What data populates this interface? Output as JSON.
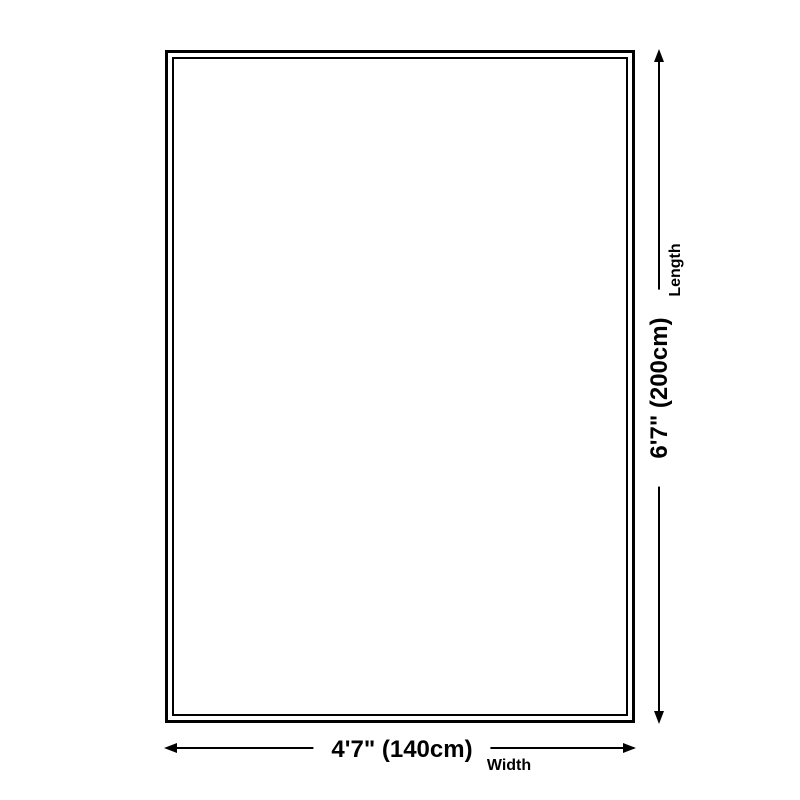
{
  "colors": {
    "line": "#000000",
    "background": "#ffffff"
  },
  "diagram": {
    "length": {
      "value": "6'7\" (200cm)",
      "label": "Length"
    },
    "width": {
      "value": "4'7\" (140cm)",
      "label": "Width"
    }
  }
}
